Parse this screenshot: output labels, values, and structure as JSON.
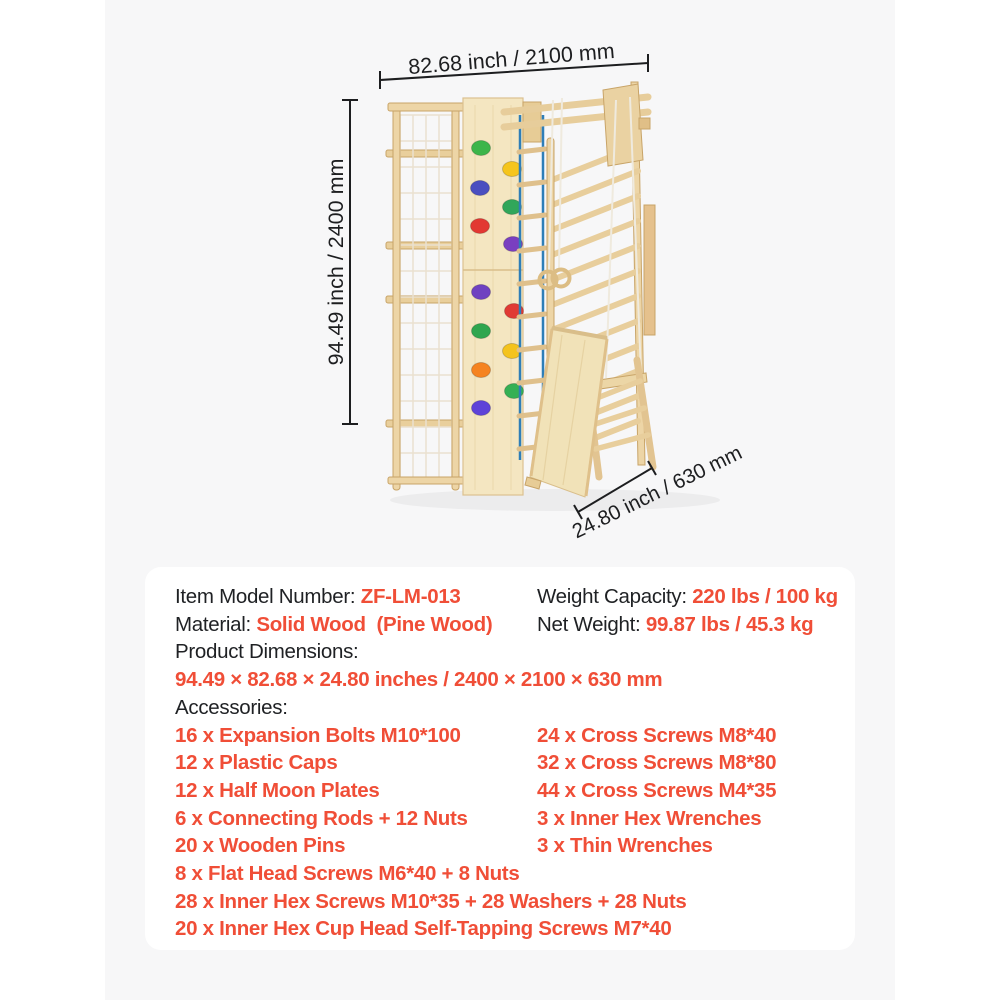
{
  "colors": {
    "accent_red": "#F04E37",
    "text_dark": "#1F2124",
    "page_bg": "#FFFFFF",
    "photo_bg": "#F7F7F8",
    "card_bg": "#FFFFFF",
    "wood": "#EDD5A6",
    "wood_dark": "#C8A468",
    "board_wood": "#F4E6C1",
    "rope_blue": "#2E7EB8",
    "rope_white": "#EFEADE"
  },
  "diagram": {
    "width_label": "82.68 inch / 2100 mm",
    "height_label": "94.49 inch / 2400 mm",
    "depth_label": "24.80 inch / 630 mm",
    "hold_colors": [
      "#3CB54A",
      "#F5C51D",
      "#4A4FC0",
      "#31A65A",
      "#E23832",
      "#7A3FC0",
      "#6F42C1",
      "#E03A34",
      "#2FA64F",
      "#F4C31D",
      "#F58320",
      "#35B054",
      "#5E43D8"
    ]
  },
  "specs": {
    "item_model_label": "Item Model Number:",
    "item_model_value": "ZF-LM-013",
    "weight_capacity_label": "Weight Capacity:",
    "weight_capacity_value": "220 lbs / 100 kg",
    "material_label": "Material:",
    "material_value": "Solid Wood  (Pine Wood)",
    "net_weight_label": "Net Weight:",
    "net_weight_value": "99.87 lbs / 45.3 kg",
    "product_dimensions_label": "Product Dimensions:",
    "product_dimensions_value": "94.49 × 82.68 × 24.80 inches / 2400 × 2100 × 630 mm",
    "accessories_label": "Accessories:",
    "accessories_left": [
      "16 x Expansion Bolts M10*100",
      "12 x Plastic Caps",
      "12 x Half Moon Plates",
      "6 x Connecting Rods + 12 Nuts",
      "20 x Wooden Pins",
      "8 x Flat Head Screws M6*40 + 8 Nuts",
      "28 x Inner Hex Screws M10*35 + 28 Washers + 28 Nuts",
      "20 x Inner Hex Cup Head Self-Tapping Screws M7*40"
    ],
    "accessories_right": [
      "24 x Cross Screws M8*40",
      "32 x Cross Screws M8*80",
      "44 x Cross Screws M4*35",
      "3 x Inner Hex Wrenches",
      "3 x Thin Wrenches"
    ]
  }
}
